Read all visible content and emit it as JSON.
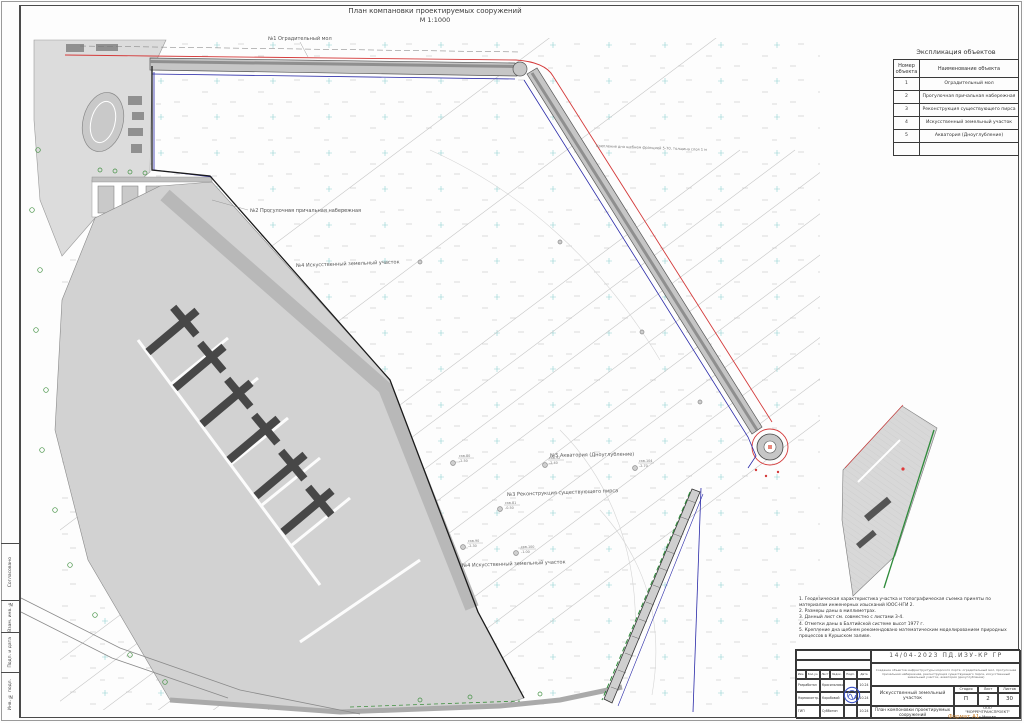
{
  "sheet": {
    "title": "План компановки проектируемых сооружений",
    "scale": "М 1:1000",
    "format": "Формат А1"
  },
  "frame": {
    "left_labels": [
      "Согласовано",
      "Взам. инв. №",
      "Подп. и дата",
      "Инв. № подл."
    ]
  },
  "explication": {
    "title": "Экспликация объектов",
    "columns": {
      "number": "Номер объекта",
      "name": "Наименование объекта"
    },
    "rows": [
      {
        "num": "1",
        "name": "Оградительный мол"
      },
      {
        "num": "2",
        "name": "Прогулочная причальная набережная"
      },
      {
        "num": "3",
        "name": "Реконструкция существующего пирса"
      },
      {
        "num": "4",
        "name": "Искусственный земельный участок"
      },
      {
        "num": "5",
        "name": "Акватория (Дноуглубление)"
      },
      {
        "num": "",
        "name": ""
      }
    ]
  },
  "plan": {
    "labels": {
      "breakwater": "№1 Оградительный мол",
      "promenade": "№2 Прогулочная причальная набережная",
      "land_plot_top": "№4 Искусственный земельный участок",
      "aquatory": "№5 Акватория (Дноуглубление)",
      "pier_reconstruction": "№3 Реконструкция существующего пирса",
      "land_plot_bottom": "№4 Искусственный земельный участок",
      "bed_protection": "Крепление дна щебнем фракцией 5-70, толщина слоя 1 м"
    },
    "boreholes": [
      {
        "name": "скв.80",
        "elev": "-2.50"
      },
      {
        "name": "скв.92",
        "elev": "-2.40"
      },
      {
        "name": "скв.104",
        "elev": "-2.70"
      },
      {
        "name": "скв.81",
        "elev": "-0.50"
      },
      {
        "name": "скв.90",
        "elev": "-2.30"
      },
      {
        "name": "скв.100",
        "elev": "-1.00"
      }
    ]
  },
  "notes": {
    "lines": [
      "1. Геодезическая характеристика участка и топографическая съемка приняты по материалам инженерных изысканий ЮОС-НГИ 2.",
      "2. Размеры даны в миллиметрах.",
      "3. Данный лист см. совместно с листами 3-4.",
      "4. Отметки даны в Балтийской системе высот 1977 г.",
      "5. Крепление дна щебнем рекомендовано математическим моделированием природных процессов в Куршском заливе."
    ]
  },
  "title_block": {
    "doc_code": "14/04-2023 ПД.ИЗУ-КР ГР",
    "description": "Создание объектов инфраструктуры морского порта: оградительный мол, прогулочная причальная набережная, реконструкция существующего пирса, искусственный земельный участок, акватория (дноуглубление)",
    "columns": [
      "Изм.",
      "Кол.уч.",
      "Лист",
      "№док.",
      "Подп.",
      "Дата"
    ],
    "signatures": [
      {
        "role": "Разработал",
        "name": "Красильников",
        "date": "10.24"
      },
      {
        "role": "Нормоконтр.",
        "name": "Коробовой",
        "date": "10.24"
      },
      {
        "role": "ГИП",
        "name": "Субботин",
        "date": "10.24"
      }
    ],
    "object_name": "Искусственный земельный участок",
    "stage_label": "Стадия",
    "stage": "П",
    "sheet_label": "Лист",
    "sheet_num": "2",
    "sheets_label": "Листов",
    "sheets_total": "30",
    "drawing_name": "План компоновки проектируемых сооружений",
    "company_line1": "ООО",
    "company_line2": "\"МОРРЕЧТРАНСПРОЕКТ\"",
    "company_line3": "г.Москва"
  },
  "colors": {
    "boundary_red": "#d43a3a",
    "boundary_blue": "#2a2aa8",
    "shore_green": "#3f8f3f",
    "stamp_blue": "#3a52c8",
    "land_gray": "#d2d2d2"
  }
}
